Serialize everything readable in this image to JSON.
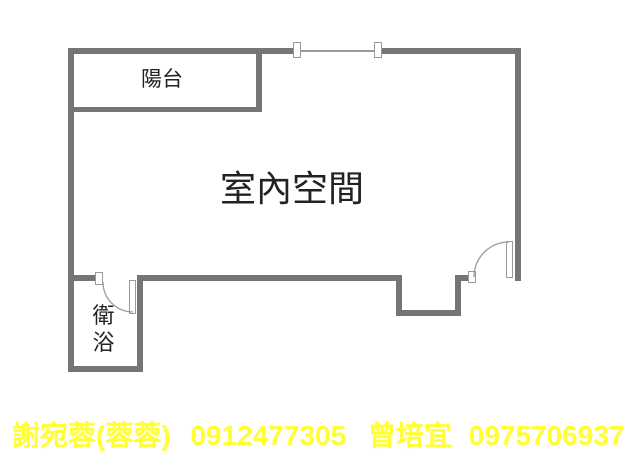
{
  "floorplan": {
    "rooms": {
      "balcony_label": "陽台",
      "indoor_label": "室內空間",
      "bathroom_label": "衛浴"
    },
    "fixtures": {
      "window": "top-wall-window",
      "bathroom_door": "swing-door-into-bathroom",
      "entry_door": "swing-door-bottom-right"
    },
    "colors": {
      "wall": "#757575",
      "fixture_line": "#9a9a9a",
      "label_text": "#222222",
      "background": "#ffffff",
      "contact_text": "#ffff32"
    }
  },
  "contact": {
    "agents": [
      {
        "name": "謝宛蓉(蓉蓉)",
        "phone": "0912477305"
      },
      {
        "name": "曾培宜",
        "phone": "0975706937"
      }
    ]
  }
}
